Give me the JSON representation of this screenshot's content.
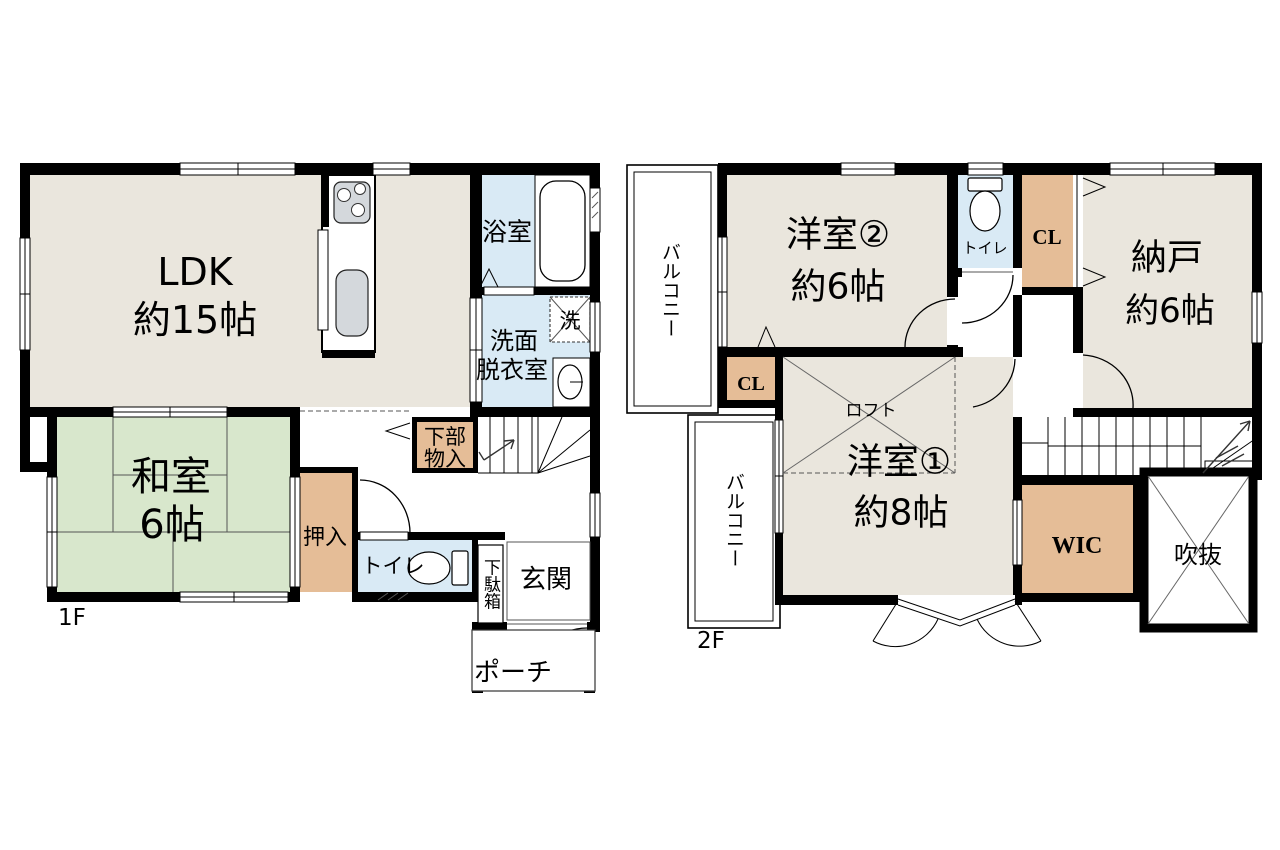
{
  "colors": {
    "room_beige": "#EAE6DD",
    "tatami_green": "#D8E7CC",
    "water_blue": "#D9EAF5",
    "closet_tan": "#E5BD97",
    "wall_black": "#000000",
    "fixture_gray": "#D4D8DC"
  },
  "floor1": {
    "label": "1F",
    "rooms": {
      "ldk": {
        "name": "LDK",
        "size": "約15帖"
      },
      "washitsu": {
        "name": "和室",
        "size": "6帖"
      },
      "bath": {
        "name": "浴室"
      },
      "laundry": {
        "name": "洗"
      },
      "senmen": {
        "line1": "洗面",
        "line2": "脱衣室"
      },
      "kabu": {
        "line1": "下部",
        "line2": "物入"
      },
      "oshiire": {
        "name": "押入"
      },
      "toilet": {
        "name": "トイレ"
      },
      "getabako": {
        "name": "下駄箱"
      },
      "genkan": {
        "name": "玄関"
      },
      "porch": {
        "name": "ポーチ"
      }
    }
  },
  "floor2": {
    "label": "2F",
    "rooms": {
      "balcony_top": {
        "name": "バルコニー"
      },
      "yoshitsu2": {
        "name": "洋室②",
        "size": "約6帖"
      },
      "toilet": {
        "name": "トイレ"
      },
      "cl_top": {
        "name": "CL"
      },
      "nando": {
        "name": "納戸",
        "size": "約6帖"
      },
      "cl_left": {
        "name": "CL"
      },
      "loft": {
        "name": "ロフト"
      },
      "yoshitsu1": {
        "name": "洋室①",
        "size": "約8帖"
      },
      "balcony_bottom": {
        "name": "バルコニー"
      },
      "wic": {
        "name": "WIC"
      },
      "fukinuke": {
        "name": "吹抜"
      }
    }
  }
}
